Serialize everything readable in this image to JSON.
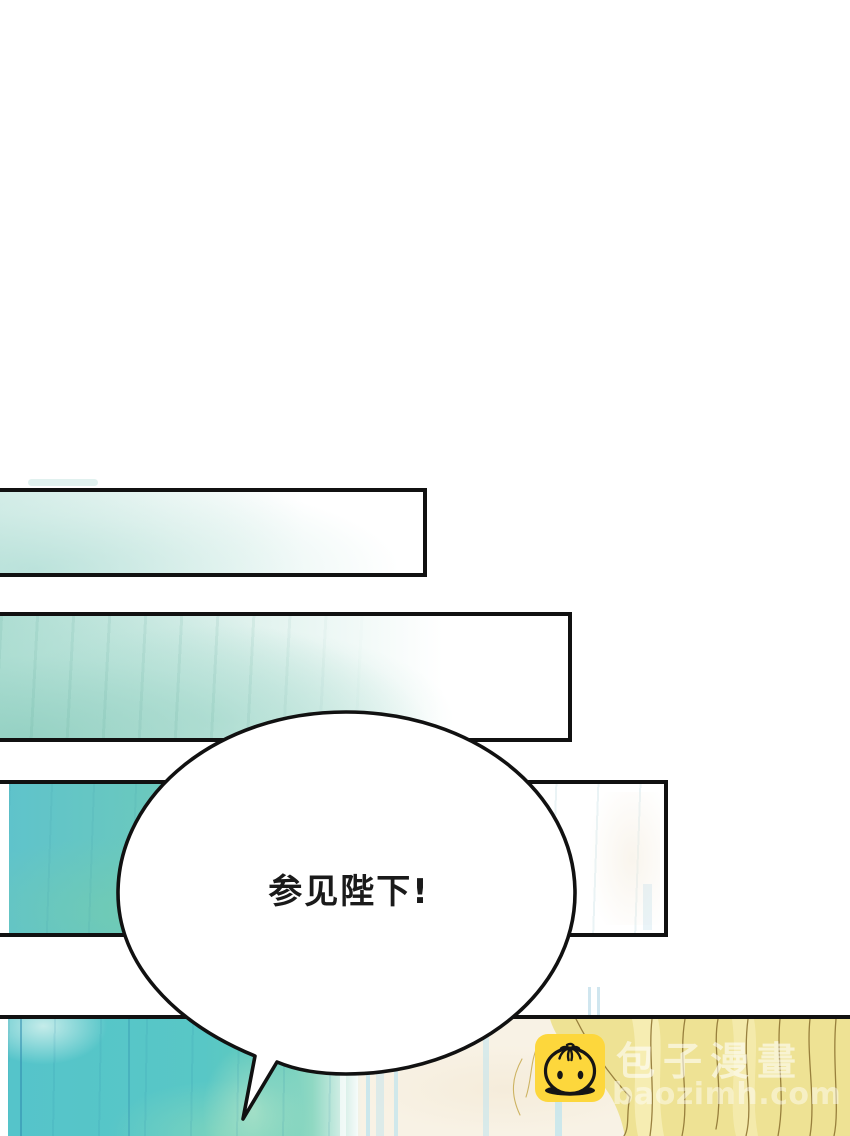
{
  "page": {
    "kind": "webtoon-comic-page",
    "language": "zh",
    "background": "#ffffff"
  },
  "speech_bubble": {
    "text": "参见陛下!"
  },
  "watermark": {
    "site_name": "包子漫畫",
    "site_url": "baozimh.com",
    "icon": "baozi-steamed-bun-icon",
    "icon_color": "#fdd73c"
  },
  "palette": {
    "panel_border": "#111111",
    "ink": "#1a1a1a",
    "mint_pale": "#ddf0ec",
    "teal_soft": "#a9dcd2",
    "turquoise": "#5fc6c7",
    "turquoise_deep": "#4bbdd0",
    "green_wash": "#74cfae",
    "stripe_blue": "#bfe4ee",
    "cream": "#f8f2e5",
    "hair_yellow": "#eee294",
    "hair_strand": "#8a6f2e",
    "icon_yellow": "#fdd73c"
  }
}
